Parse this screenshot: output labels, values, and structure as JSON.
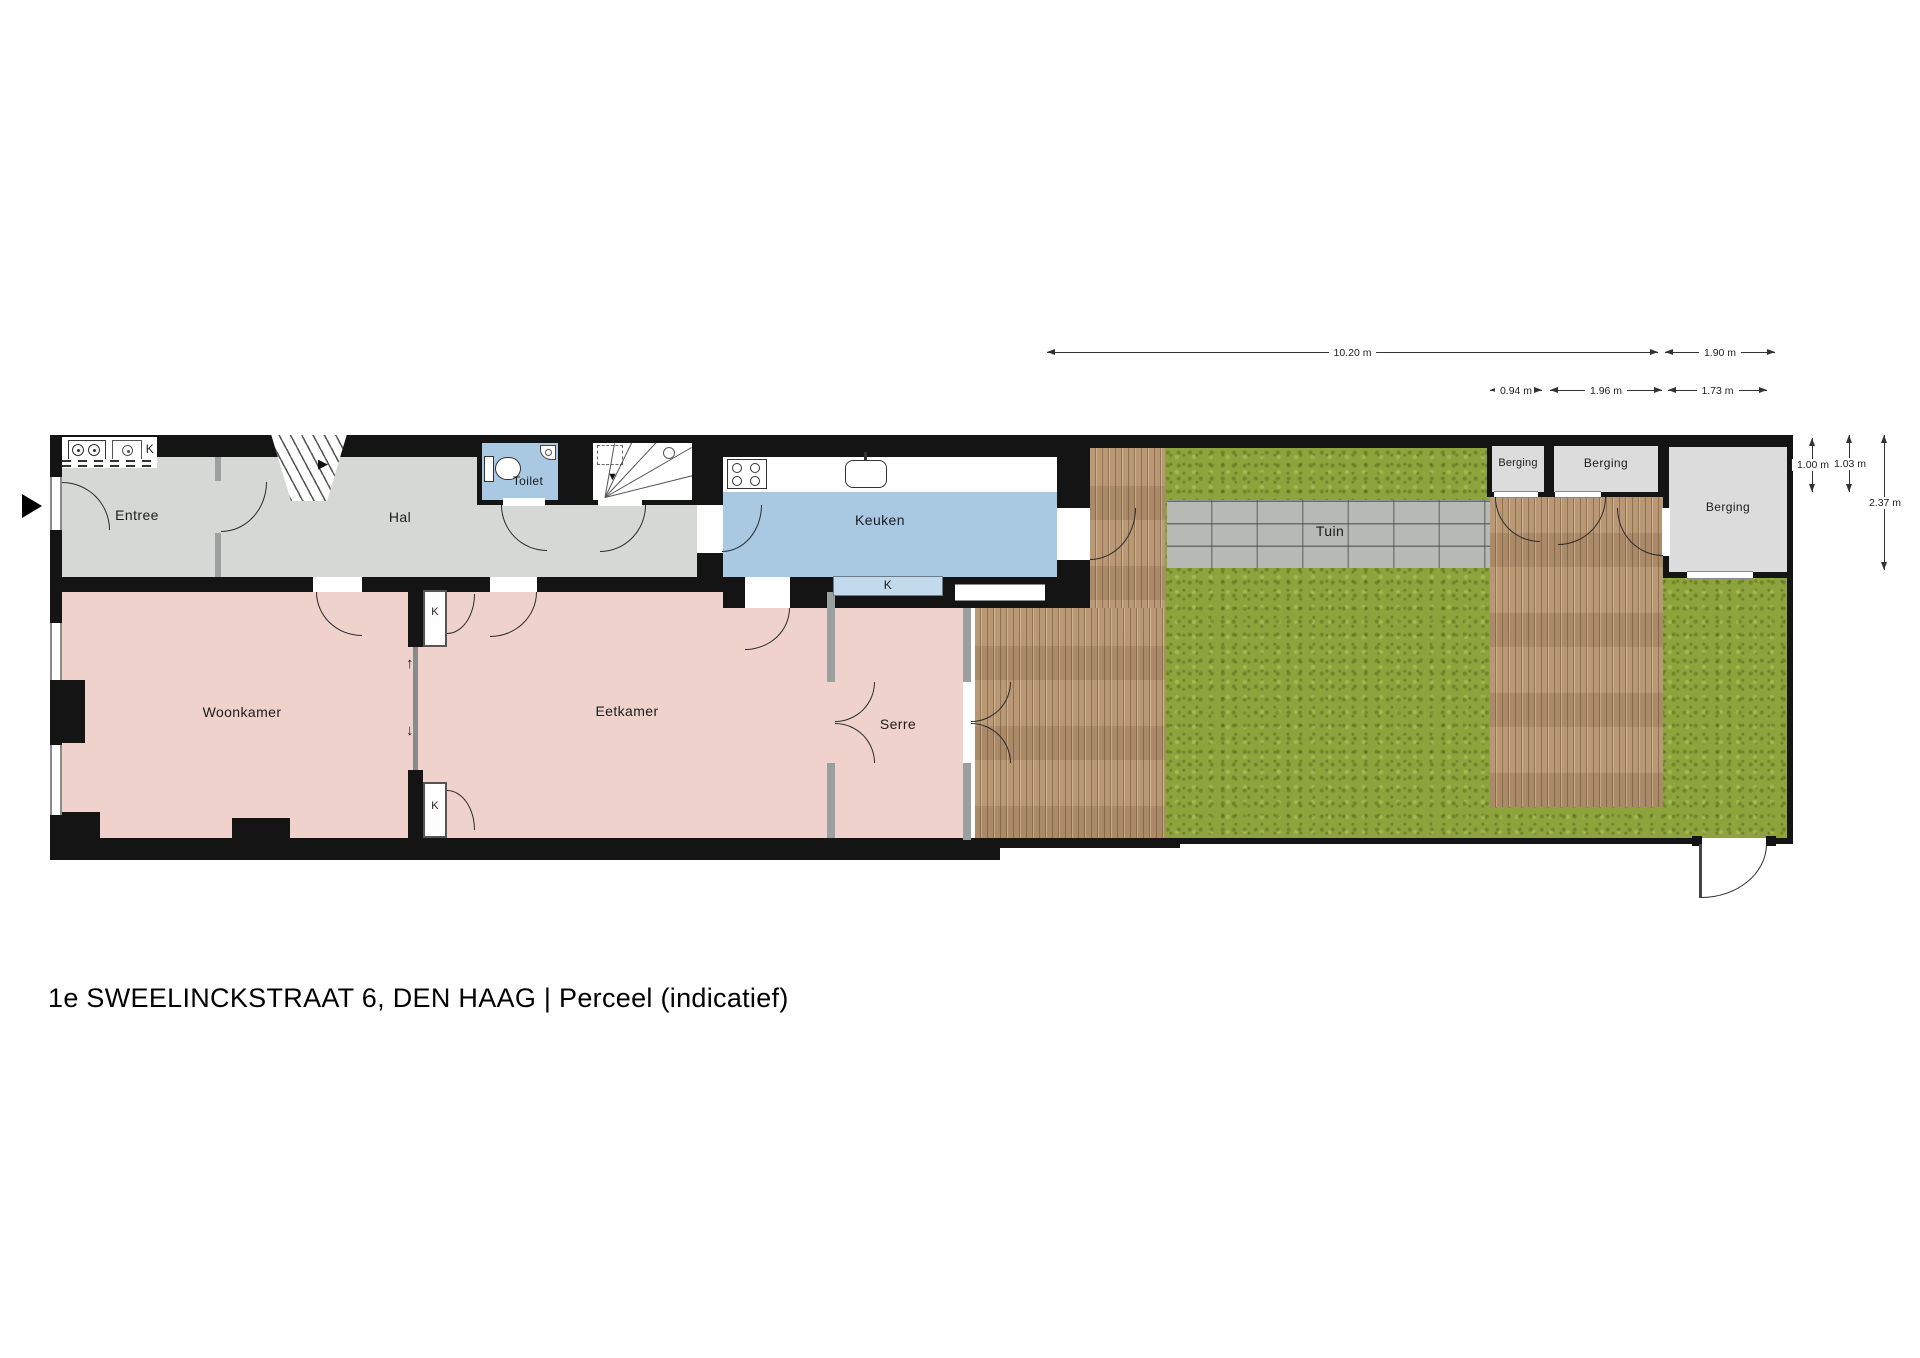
{
  "title": "1e SWEELINCKSTRAAT 6, DEN HAAG  | Perceel  (indicatief)",
  "rooms": {
    "entree": "Entree",
    "hal": "Hal",
    "toilet": "Toilet",
    "keuken": "Keuken",
    "woonkamer": "Woonkamer",
    "eetkamer": "Eetkamer",
    "serre": "Serre",
    "tuin": "Tuin",
    "berging": "Berging",
    "closet_k": "K"
  },
  "dimensions": {
    "d_total": "10.20 m",
    "d_b3": "1.90 m",
    "d_w1": "0.94 m",
    "d_w2": "1.96 m",
    "d_w3": "1.73 m",
    "d_h1": "1.00 m",
    "d_h2": "1.03 m",
    "d_h3": "2.37 m"
  },
  "icons": {
    "entrance_marker": "▶",
    "stairs_up": "▶",
    "stairs_down": "▼",
    "slide_up": "↑",
    "slide_down": "↓"
  },
  "colors": {
    "wall": "#141414",
    "room_grey": "#d5d8d4",
    "room_pink": "#efd2cc",
    "room_blue": "#a9c8e2",
    "closet_blue": "#c3d9ec",
    "berging_grey": "#dcdcdd",
    "grass": "#8da33c",
    "wood": "#b5926f",
    "stone_path": "#b6b9b4"
  }
}
